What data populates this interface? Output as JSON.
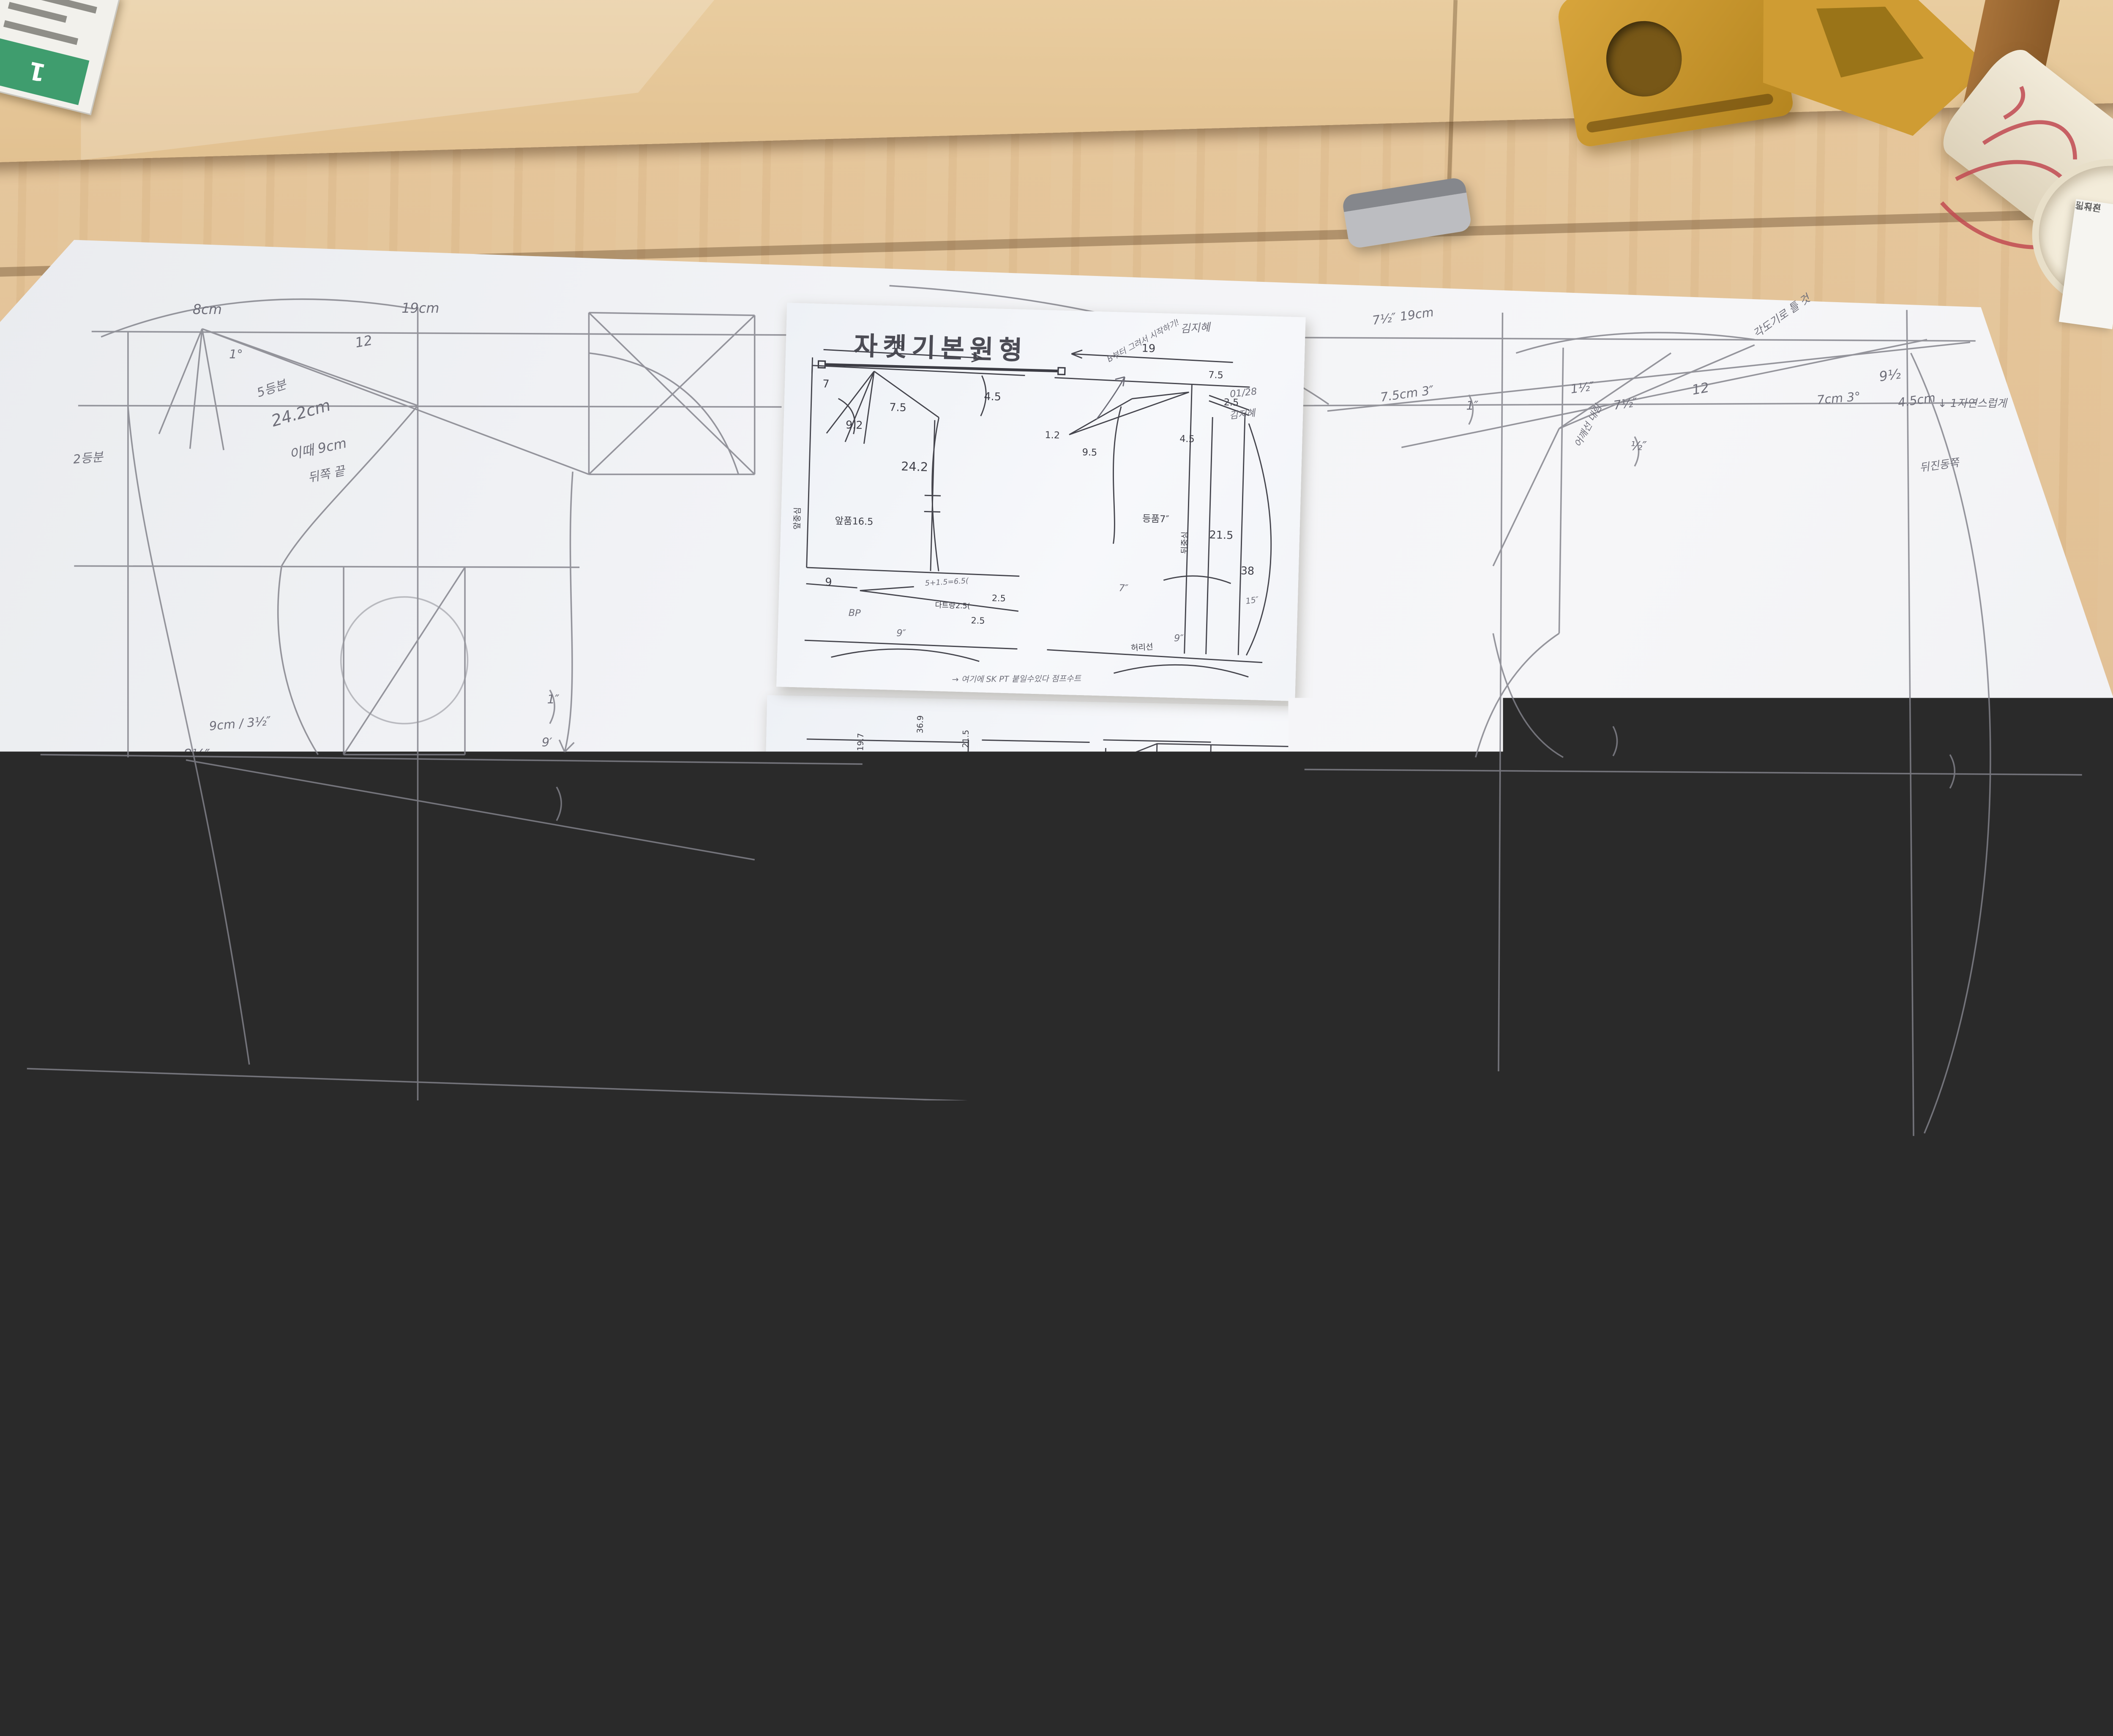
{
  "scene_type": "photo of fashion pattern drafting desk",
  "paper": {
    "annotations": [
      "8cm",
      "19cm",
      "1°",
      "12",
      "5등분",
      "24.2cm",
      "이때 9cm",
      "뒤쪽 끝",
      "2등분",
      "9cm / 3½″",
      "8½″",
      "BP",
      "MP",
      "9′",
      "1″",
      "1″",
      "EP",
      "15°",
      "9°",
      "9°",
      "7½″ 19cm",
      "7.5cm 3″",
      "1″",
      "1½″",
      "7½″",
      "12",
      "4.5cm",
      "½″",
      "어깨선 내림",
      "각도기로 틀 것",
      "9½",
      "7cm 3°",
      "↓ 1자연스럽게",
      "뒤진동쪽",
      "2″",
      "2°",
      "등폭 7″",
      "15″",
      "5등분선"
    ]
  },
  "sheet1": {
    "title": "자켓기본원형",
    "annotations": [
      "19",
      "7",
      "9.2",
      "7.5",
      "4.5",
      "24.2",
      "앞중심",
      "앞품16.5",
      "9",
      "BP",
      "5+1.5=6.5(",
      "다트량2.5(",
      "2.5",
      "2.5",
      "19",
      "7.5",
      "1.2",
      "9.5",
      "4.5",
      "등품7″",
      "뒤중심",
      "2.5",
      "21.5",
      "38",
      "15″",
      "허리선",
      "9″",
      "9″",
      "7″",
      "→ 여기에 SK PT 붙일수있다 점프수트",
      "B부터 그려서 시작하기!",
      "01/28",
      "김지혜",
      "김지혜"
    ]
  },
  "sheet2": {
    "measurements": [
      "어깨:34.5",
      "상동:86.5",
      "허리:70",
      "힙:91.5",
      "기장:97.5"
    ],
    "annotations": [
      "19.7",
      "36.9",
      "21.5",
      "23",
      "1",
      "5.5",
      "16",
      "28",
      "18",
      "6.5",
      "22.5",
      "1.3",
      "2.5",
      "단NO20",
      "01/28 김지혜"
    ]
  },
  "tools": {
    "ruler_upper": {
      "name": "김지혜"
    },
    "ruler_lower": {
      "name": "김지혜",
      "numbers": [
        "20",
        "25"
      ]
    },
    "curve": {
      "stamp": "암홀자 앞몸판-n 1 시접:1",
      "name": "김지혜",
      "note": "몸판곱자"
    }
  },
  "cup": {
    "note_line1": "노지혼",
    "note_line2": "김유진"
  },
  "corner_card": {
    "number": "1"
  }
}
